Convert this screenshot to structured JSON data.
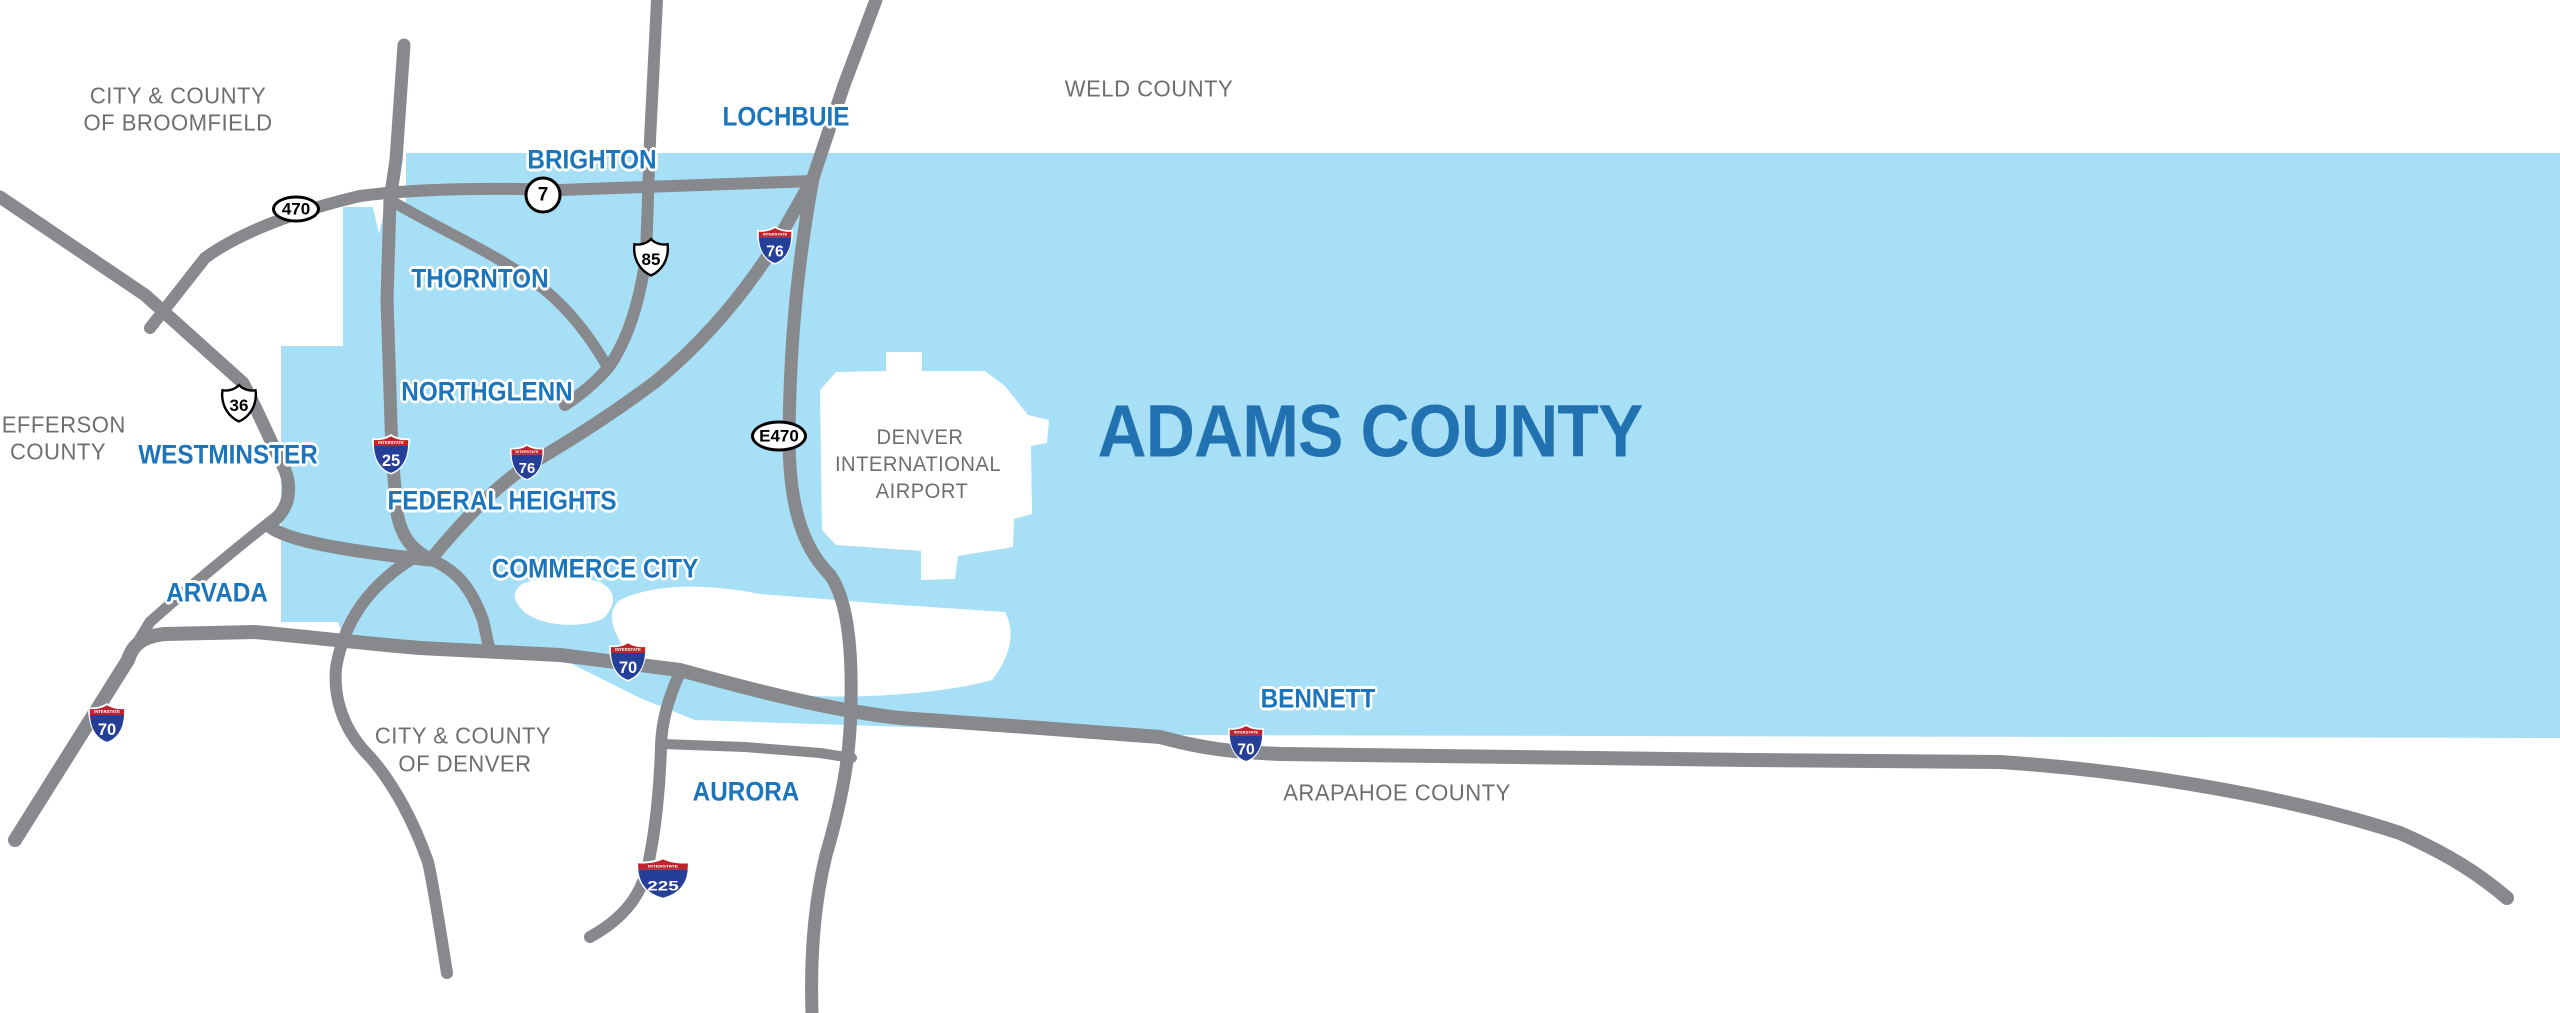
{
  "colors": {
    "county_fill": "#A6DFF6",
    "road_gray": "#87898C",
    "city_blue": "#1B75BC",
    "title_blue": "#2272B2",
    "gray_text": "#6D6E71",
    "interstate_red": "#C0232C",
    "interstate_blue": "#253E97"
  },
  "title": {
    "id": "adams-county",
    "text": "ADAMS COUNTY",
    "x": 1370,
    "y": 431
  },
  "city_labels": [
    {
      "id": "lochbuie",
      "text": "LOCHBUIE",
      "x": 786,
      "y": 117
    },
    {
      "id": "brighton",
      "text": "BRIGHTON",
      "x": 592,
      "y": 160
    },
    {
      "id": "thornton",
      "text": "THORNTON",
      "x": 480,
      "y": 279
    },
    {
      "id": "northglenn",
      "text": "NORTHGLENN",
      "x": 487,
      "y": 392
    },
    {
      "id": "westminster",
      "text": "WESTMINSTER",
      "x": 228,
      "y": 455
    },
    {
      "id": "federal-heights",
      "text": "FEDERAL HEIGHTS",
      "x": 502,
      "y": 501
    },
    {
      "id": "arvada",
      "text": "ARVADA",
      "x": 217,
      "y": 593
    },
    {
      "id": "commerce-city",
      "text": "COMMERCE CITY",
      "x": 595,
      "y": 569
    },
    {
      "id": "aurora",
      "text": "AURORA",
      "x": 746,
      "y": 792
    },
    {
      "id": "bennett",
      "text": "BENNETT",
      "x": 1318,
      "y": 699
    }
  ],
  "area_labels": [
    {
      "id": "broomfield-1",
      "text": "CITY & COUNTY",
      "x": 178,
      "y": 96,
      "size": 23
    },
    {
      "id": "broomfield-2",
      "text": "OF BROOMFIELD",
      "x": 178,
      "y": 123,
      "size": 23
    },
    {
      "id": "weld-county",
      "text": "WELD COUNTY",
      "x": 1149,
      "y": 89,
      "size": 23
    },
    {
      "id": "jefferson-1",
      "text": "JEFFERSON",
      "x": 58,
      "y": 425,
      "size": 23
    },
    {
      "id": "jefferson-2",
      "text": "COUNTY",
      "x": 58,
      "y": 452,
      "size": 23
    },
    {
      "id": "denver-1",
      "text": "CITY & COUNTY",
      "x": 463,
      "y": 736,
      "size": 23
    },
    {
      "id": "denver-2",
      "text": "OF DENVER",
      "x": 465,
      "y": 764,
      "size": 23
    },
    {
      "id": "arapahoe",
      "text": "ARAPAHOE COUNTY",
      "x": 1397,
      "y": 793,
      "size": 23
    },
    {
      "id": "dia-1",
      "text": "DENVER",
      "x": 920,
      "y": 438,
      "size": 21
    },
    {
      "id": "dia-2",
      "text": "INTERNATIONAL",
      "x": 918,
      "y": 465,
      "size": 21
    },
    {
      "id": "dia-3",
      "text": "AIRPORT",
      "x": 922,
      "y": 492,
      "size": 21
    }
  ],
  "badges": [
    {
      "id": "i70-west",
      "kind": "interstate",
      "label": "70",
      "x": 107,
      "y": 723,
      "w": 40,
      "h": 42
    },
    {
      "id": "i70-mid",
      "kind": "interstate",
      "label": "70",
      "x": 628,
      "y": 661,
      "w": 40,
      "h": 42
    },
    {
      "id": "i70-east",
      "kind": "interstate",
      "label": "70",
      "x": 1246,
      "y": 743,
      "w": 38,
      "h": 40
    },
    {
      "id": "i25",
      "kind": "interstate",
      "label": "25",
      "x": 391,
      "y": 454,
      "w": 40,
      "h": 42
    },
    {
      "id": "i76-north",
      "kind": "interstate",
      "label": "76",
      "x": 775,
      "y": 245,
      "w": 38,
      "h": 40
    },
    {
      "id": "i76-south",
      "kind": "interstate",
      "label": "76",
      "x": 527,
      "y": 462,
      "w": 36,
      "h": 38
    },
    {
      "id": "i225",
      "kind": "interstate-wide",
      "label": "225",
      "x": 663,
      "y": 878,
      "w": 58,
      "h": 44
    },
    {
      "id": "us85",
      "kind": "us",
      "label": "85",
      "x": 651,
      "y": 257,
      "w": 40,
      "h": 42
    },
    {
      "id": "us36",
      "kind": "us",
      "label": "36",
      "x": 239,
      "y": 403,
      "w": 40,
      "h": 42
    },
    {
      "id": "sh470",
      "kind": "oval",
      "label": "470",
      "x": 296,
      "y": 209,
      "w": 48,
      "h": 27
    },
    {
      "id": "e470",
      "kind": "oval",
      "label": "E470",
      "x": 779,
      "y": 436,
      "w": 56,
      "h": 31
    },
    {
      "id": "sh7",
      "kind": "circle",
      "label": "7",
      "x": 543,
      "y": 195,
      "w": 37,
      "h": 37
    }
  ]
}
